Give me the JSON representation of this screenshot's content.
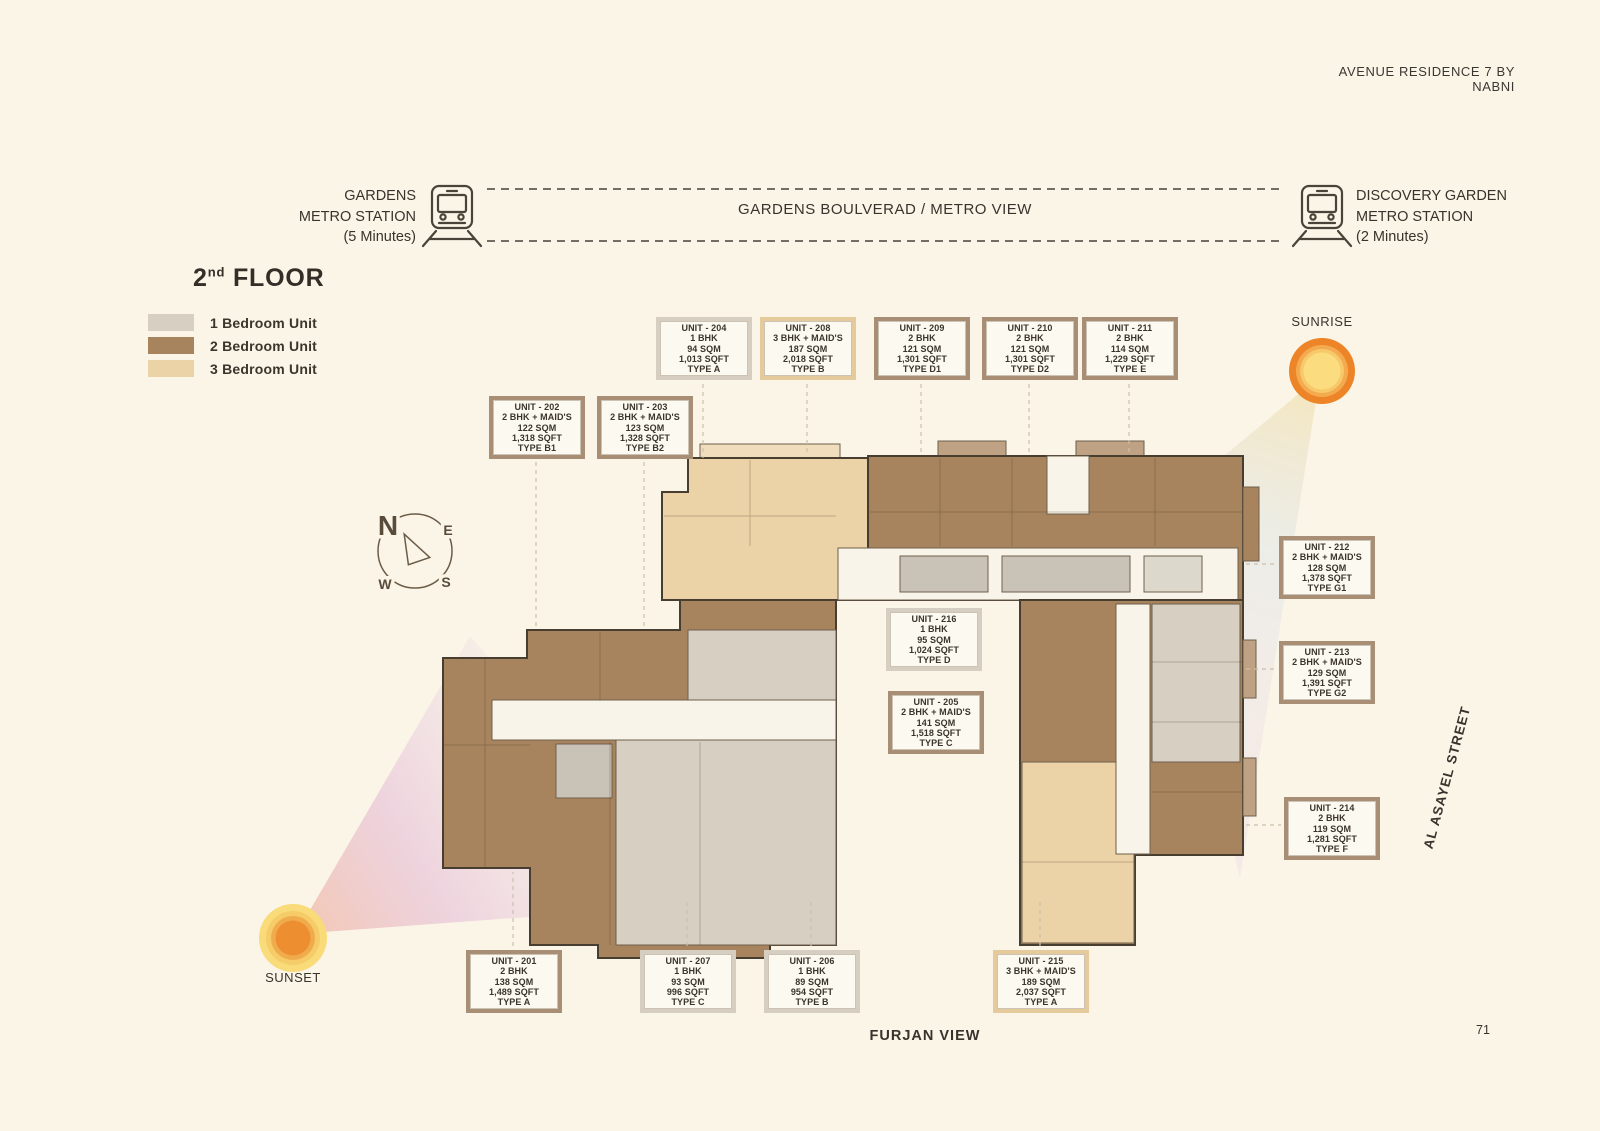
{
  "header": {
    "title": "AVENUE RESIDENCE 7 BY NABNI"
  },
  "metro": {
    "left": {
      "line1": "GARDENS",
      "line2": "METRO STATION",
      "line3": "(5 Minutes)"
    },
    "center_label": "GARDENS BOULVERAD / METRO VIEW",
    "right": {
      "line1": "DISCOVERY GARDEN",
      "line2": "METRO STATION",
      "line3": "(2 Minutes)"
    }
  },
  "floor_title": {
    "number": "2",
    "ordinal": "nd",
    "word": " FLOOR"
  },
  "legend": {
    "items": [
      {
        "label": "1 Bedroom Unit",
        "color": "#D8CFC3"
      },
      {
        "label": "2 Bedroom Unit",
        "color": "#A8845E"
      },
      {
        "label": "3 Bedroom Unit",
        "color": "#ECD3A7"
      }
    ]
  },
  "compass": {
    "north": "N",
    "east": "E",
    "south": "S",
    "west": "W"
  },
  "annotations": {
    "sunrise": "SUNRISE",
    "sunset": "SUNSET",
    "street_right": "AL ASAYEL STREET",
    "street_bottom": "FURJAN VIEW"
  },
  "page_number": "71",
  "units": [
    {
      "id": "201",
      "title": "UNIT - 201",
      "bhk": "2 BHK",
      "area_sqm": "138 SQM",
      "area_sqft": "1,489 SQFT",
      "type": "TYPE A",
      "border": "brown"
    },
    {
      "id": "202",
      "title": "UNIT - 202",
      "bhk": "2 BHK + MAID'S",
      "area_sqm": "122 SQM",
      "area_sqft": "1,318 SQFT",
      "type": "TYPE B1",
      "border": "brown"
    },
    {
      "id": "203",
      "title": "UNIT - 203",
      "bhk": "2 BHK + MAID'S",
      "area_sqm": "123 SQM",
      "area_sqft": "1,328 SQFT",
      "type": "TYPE B2",
      "border": "brown"
    },
    {
      "id": "204",
      "title": "UNIT - 204",
      "bhk": "1 BHK",
      "area_sqm": "94 SQM",
      "area_sqft": "1,013 SQFT",
      "type": "TYPE A",
      "border": "light"
    },
    {
      "id": "205",
      "title": "UNIT - 205",
      "bhk": "2 BHK + MAID'S",
      "area_sqm": "141 SQM",
      "area_sqft": "1,518 SQFT",
      "type": "TYPE C",
      "border": "brown"
    },
    {
      "id": "206",
      "title": "UNIT - 206",
      "bhk": "1 BHK",
      "area_sqm": "89 SQM",
      "area_sqft": "954 SQFT",
      "type": "TYPE B",
      "border": "light"
    },
    {
      "id": "207",
      "title": "UNIT - 207",
      "bhk": "1 BHK",
      "area_sqm": "93 SQM",
      "area_sqft": "996 SQFT",
      "type": "TYPE C",
      "border": "light"
    },
    {
      "id": "208",
      "title": "UNIT - 208",
      "bhk": "3 BHK + MAID'S",
      "area_sqm": "187 SQM",
      "area_sqft": "2,018 SQFT",
      "type": "TYPE B",
      "border": "tan"
    },
    {
      "id": "209",
      "title": "UNIT - 209",
      "bhk": "2 BHK",
      "area_sqm": "121 SQM",
      "area_sqft": "1,301 SQFT",
      "type": "TYPE D1",
      "border": "brown"
    },
    {
      "id": "210",
      "title": "UNIT - 210",
      "bhk": "2 BHK",
      "area_sqm": "121 SQM",
      "area_sqft": "1,301 SQFT",
      "type": "TYPE D2",
      "border": "brown"
    },
    {
      "id": "211",
      "title": "UNIT - 211",
      "bhk": "2 BHK",
      "area_sqm": "114 SQM",
      "area_sqft": "1,229 SQFT",
      "type": "TYPE E",
      "border": "brown"
    },
    {
      "id": "212",
      "title": "UNIT - 212",
      "bhk": "2 BHK + MAID'S",
      "area_sqm": "128 SQM",
      "area_sqft": "1,378 SQFT",
      "type": "TYPE G1",
      "border": "brown"
    },
    {
      "id": "213",
      "title": "UNIT - 213",
      "bhk": "2 BHK + MAID'S",
      "area_sqm": "129 SQM",
      "area_sqft": "1,391 SQFT",
      "type": "TYPE G2",
      "border": "brown"
    },
    {
      "id": "214",
      "title": "UNIT - 214",
      "bhk": "2 BHK",
      "area_sqm": "119 SQM",
      "area_sqft": "1,281 SQFT",
      "type": "TYPE F",
      "border": "brown"
    },
    {
      "id": "215",
      "title": "UNIT - 215",
      "bhk": "3 BHK + MAID'S",
      "area_sqm": "189 SQM",
      "area_sqft": "2,037 SQFT",
      "type": "TYPE A",
      "border": "tan"
    },
    {
      "id": "216",
      "title": "UNIT - 216",
      "bhk": "1 BHK",
      "area_sqm": "95 SQM",
      "area_sqft": "1,024 SQFT",
      "type": "TYPE D",
      "border": "light"
    }
  ]
}
